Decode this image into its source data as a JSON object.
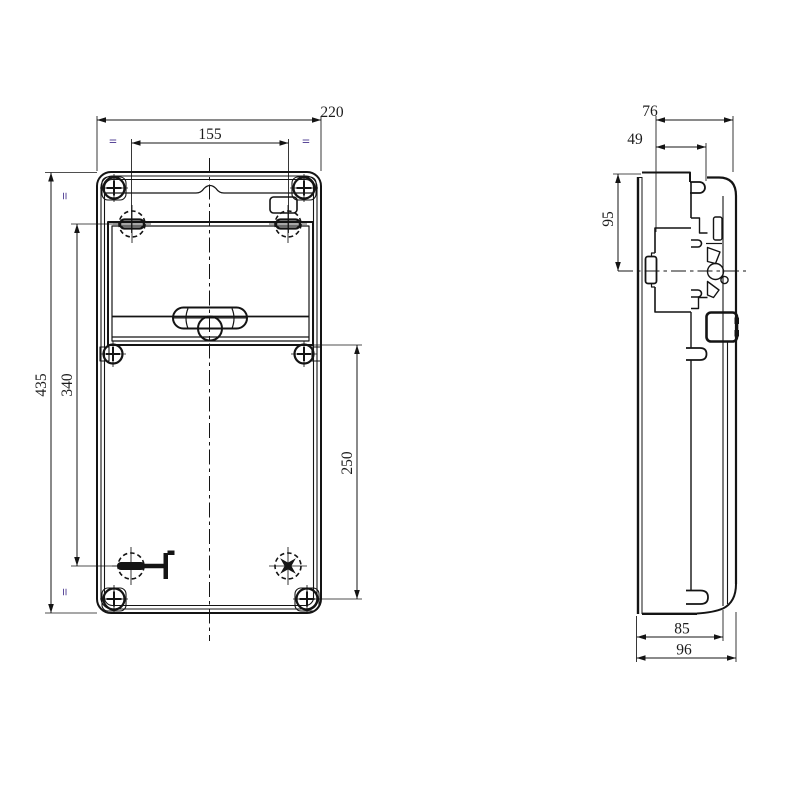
{
  "colors": {
    "line": "#141414",
    "text": "#1c1c1c",
    "equal_mark": "#5a4899",
    "background": "#ffffff"
  },
  "front_view": {
    "dim_overall_width": "220",
    "dim_hole_spacing_width": "155",
    "dim_overall_height": "435",
    "dim_hole_spacing_height": "340",
    "dim_lower_section": "250",
    "equal_mark_top_left": "=",
    "equal_mark_top_right": "=",
    "equal_mark_side_upper": "=",
    "equal_mark_side_lower": "="
  },
  "side_view": {
    "dim_depth_top": "76",
    "dim_depth_cover": "49",
    "dim_rail_to_top": "95",
    "dim_depth_body": "85",
    "dim_depth_overall": "96"
  }
}
